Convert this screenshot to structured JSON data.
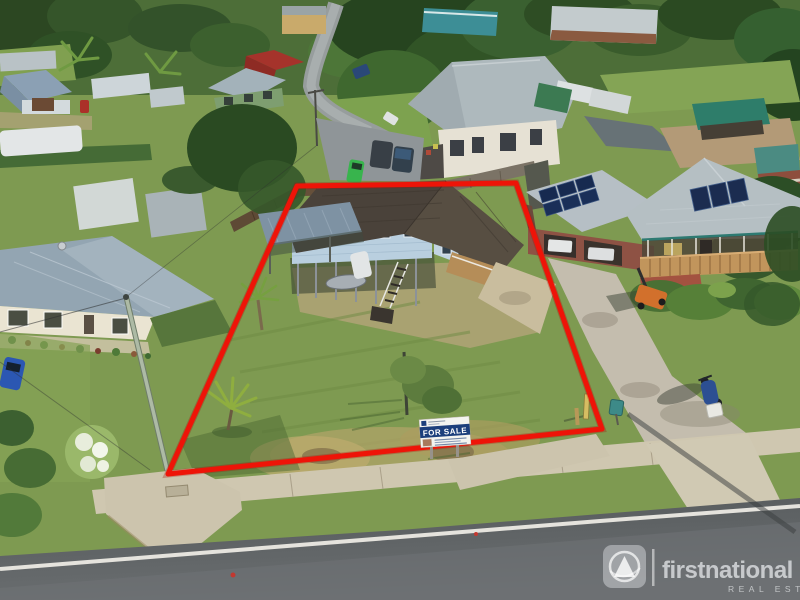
{
  "image": {
    "type": "aerial-real-estate-photo",
    "boundary_color": "#ee1408"
  },
  "for_sale_sign": {
    "label": "FOR SALE",
    "band_color": "#1c3f7c"
  },
  "watermark": {
    "brand": "firstnational",
    "tagline": "REAL ESTATE",
    "color": "#f8fafc"
  }
}
